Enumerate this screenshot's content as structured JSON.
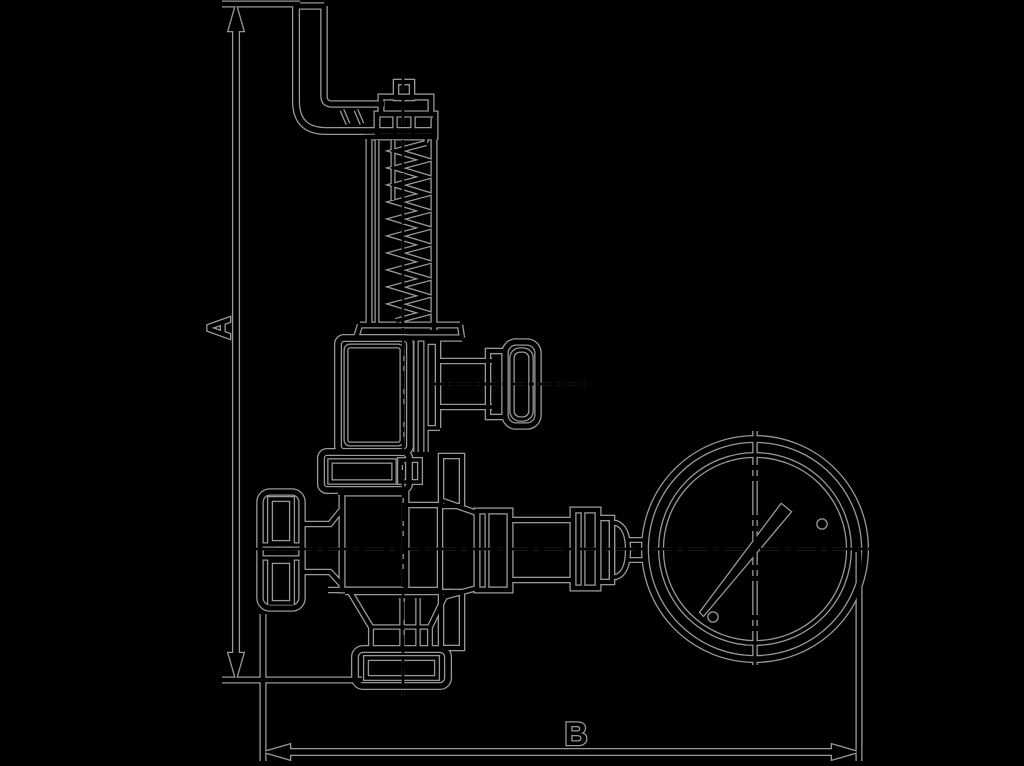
{
  "diagram": {
    "type": "technical-dimension-drawing",
    "subject": "spring-loaded safety relief valve with pressure gauge",
    "dimension_a_label": "A",
    "dimension_b_label": "B"
  },
  "colors": {
    "background": "#000000",
    "line": "#000000",
    "edge_halo": "#989898"
  },
  "components": [
    "discharge-pipe",
    "adjustment-cap",
    "spring-bonnet",
    "valve-mid-body",
    "test-knob",
    "upper-flange",
    "handwheel",
    "lower-body",
    "outlet-funnel",
    "bottom-flange",
    "gauge-piping",
    "pressure-gauge",
    "dimension-a",
    "dimension-b"
  ]
}
